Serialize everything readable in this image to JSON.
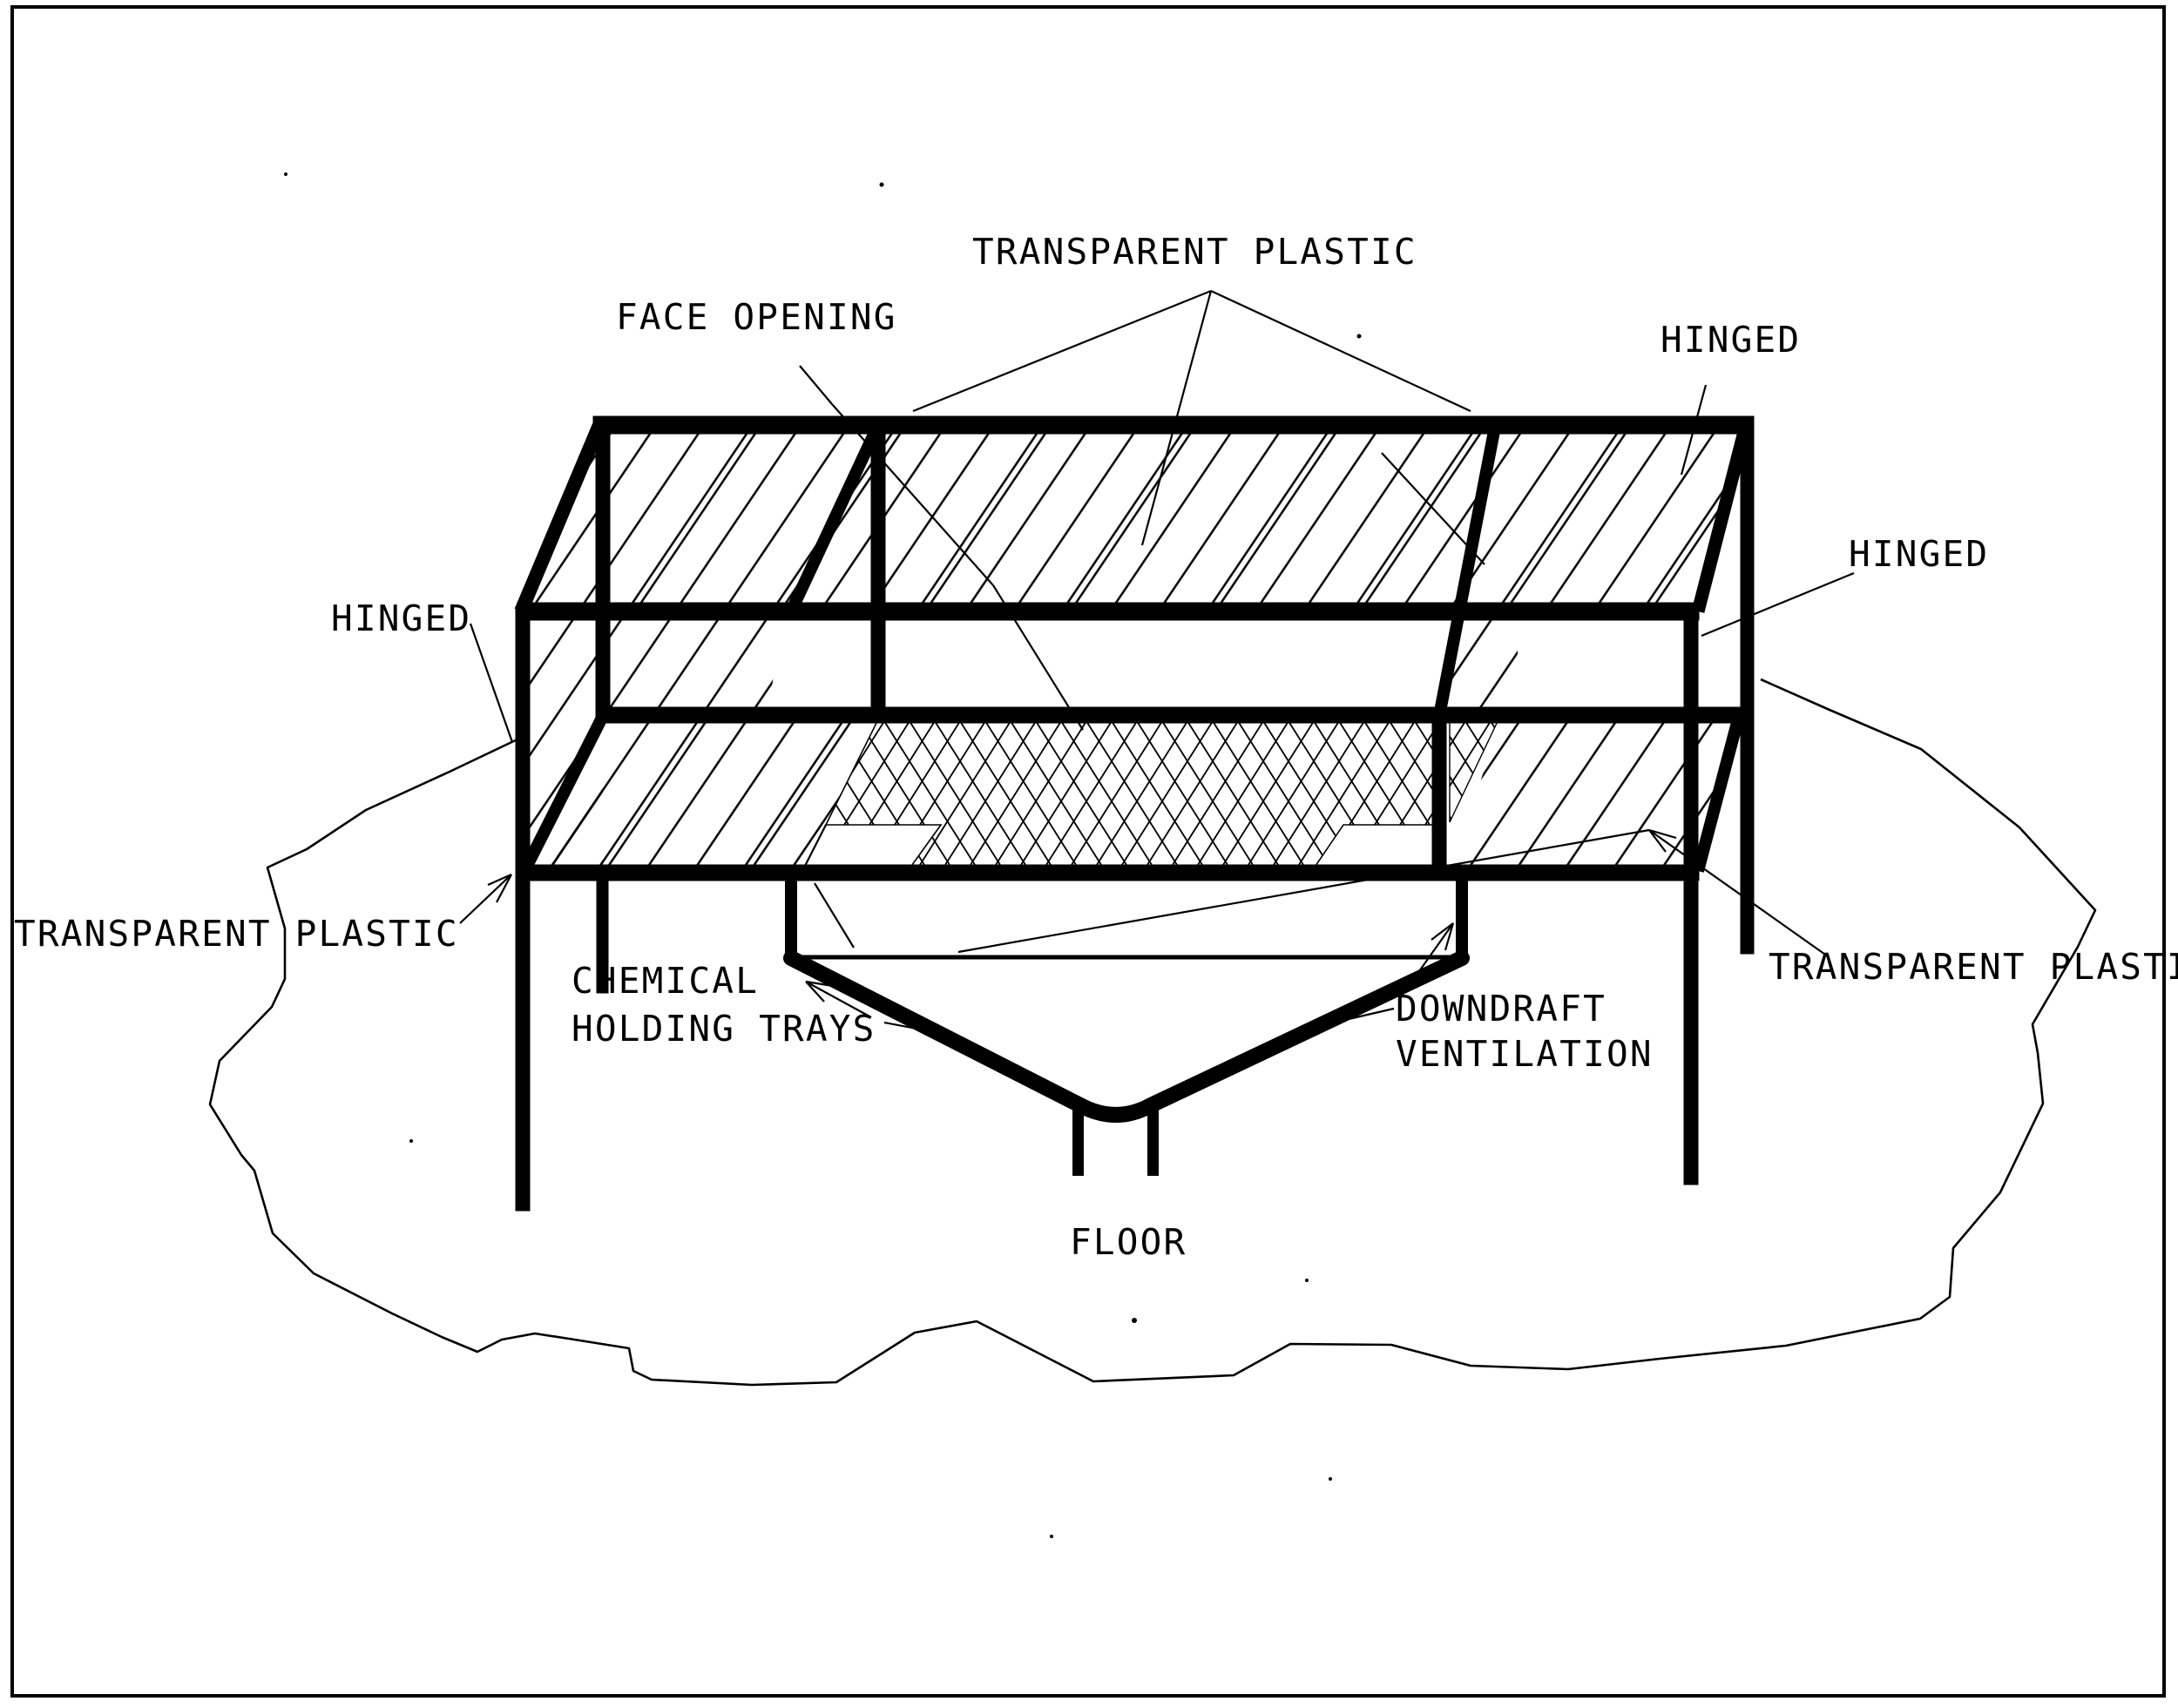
{
  "page": {
    "type": "scanned-technical-diagram",
    "paper_color": "#ffffff",
    "ink_color": "#000000",
    "border_color": "#000000"
  },
  "labels": {
    "transparent_plastic_top": "TRANSPARENT PLASTIC",
    "face_opening": "FACE OPENING",
    "hinged_top_right": "HINGED",
    "hinged_right": "HINGED",
    "hinged_left": "HINGED",
    "transparent_plastic_left": "TRANSPARENT PLASTIC",
    "chemical_line1": "CHEMICAL",
    "chemical_line2": "HOLDING TRAYS",
    "downdraft_line1": "DOWNDRAFT",
    "downdraft_line2": "VENTILATION",
    "transparent_plastic_right": "TRANSPARENT PLASTI",
    "floor": "FLOOR"
  },
  "drawing": {
    "subject": "downdraft ventilation enclosure with transparent plastic hinged panels, face opening, chemical holding trays and floor funnel",
    "panel_fill": "diagonal-hatch",
    "screen_fill": "diamond-mesh"
  }
}
